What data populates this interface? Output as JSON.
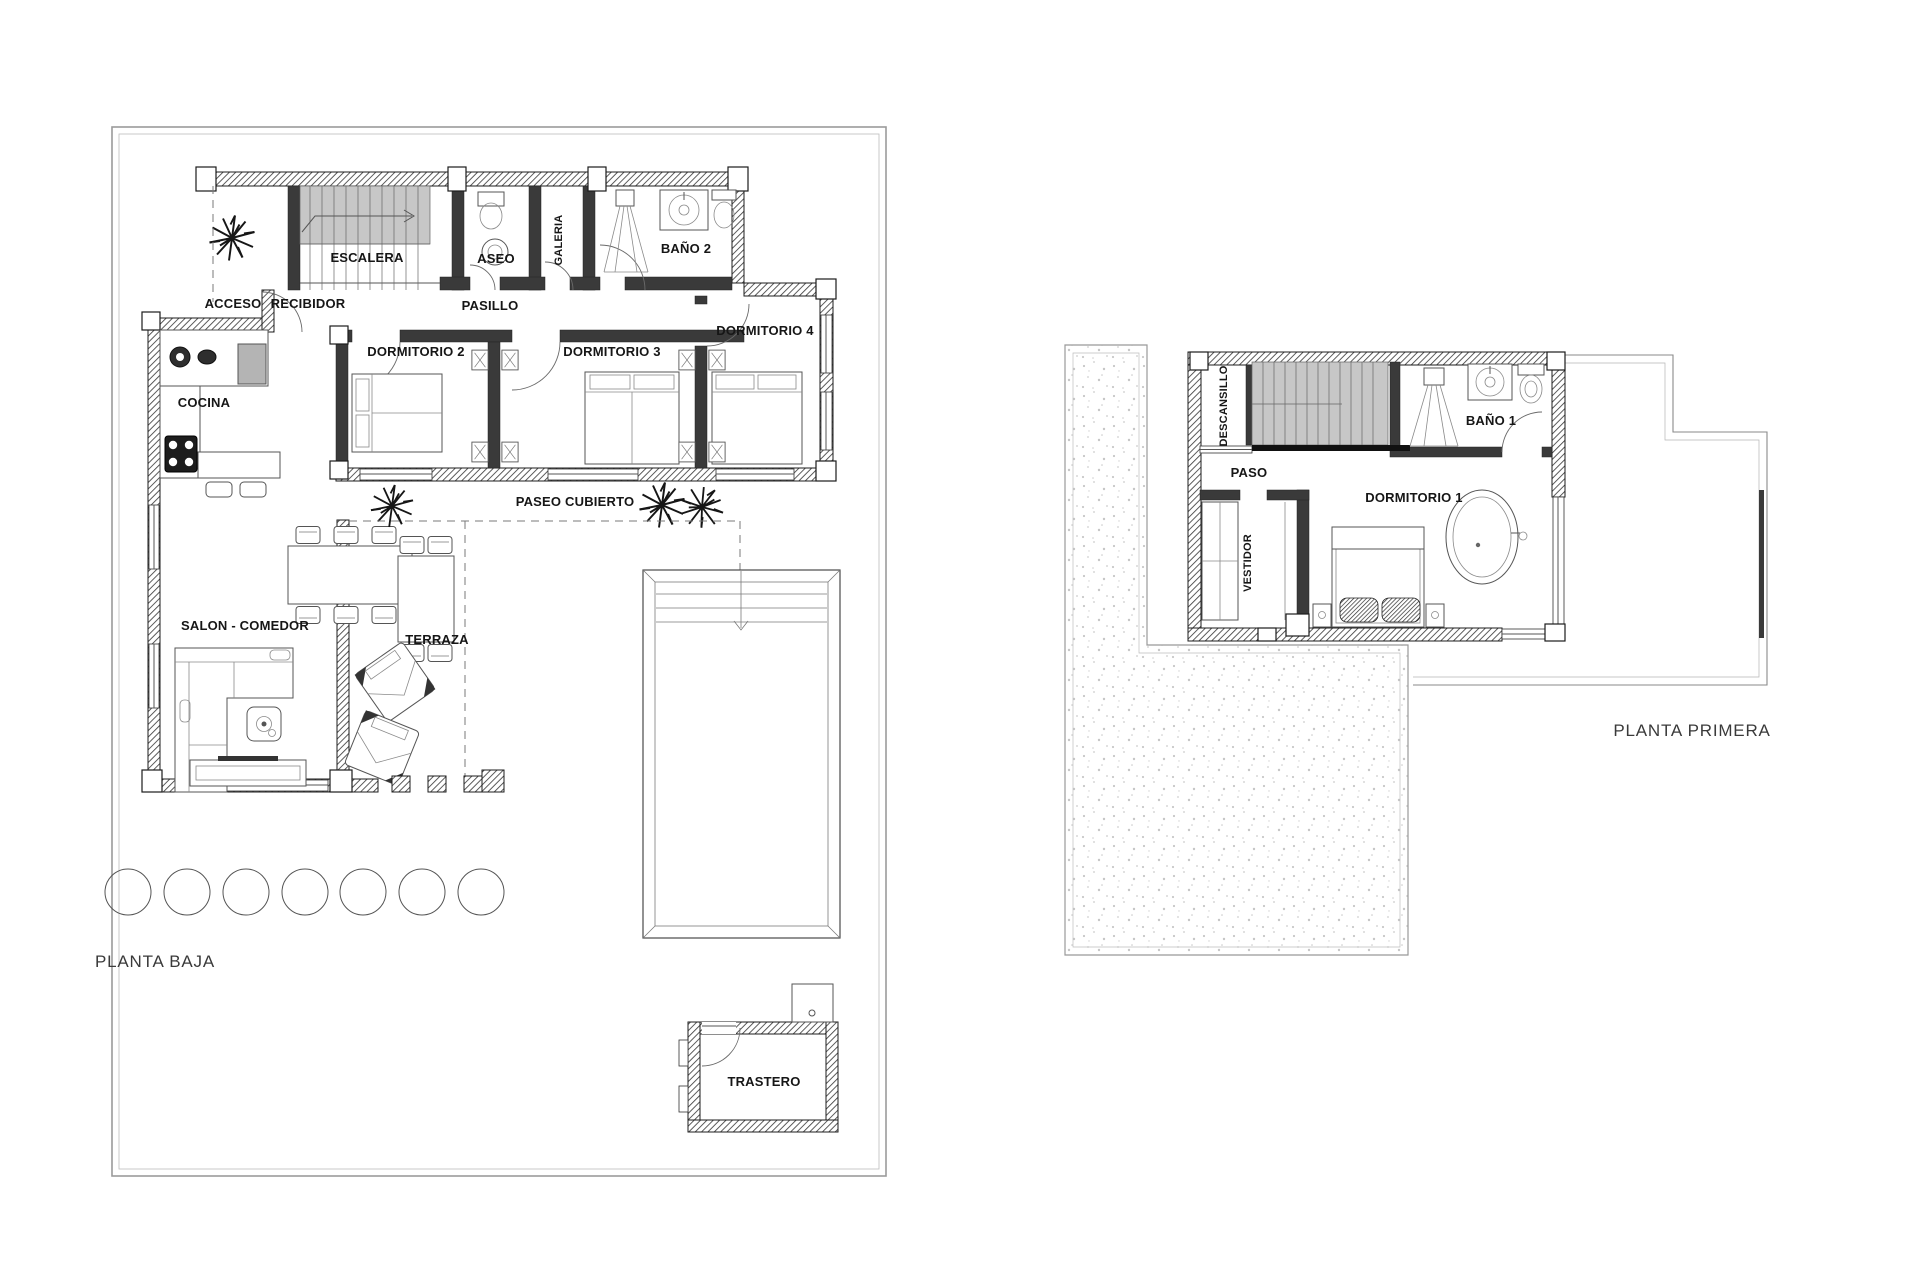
{
  "drawing": {
    "type": "architectural floor plan, two storeys of a villa",
    "background_color": "#ffffff",
    "wall_color": "#1c1c1c",
    "boundary_color": "#9b9b9b",
    "stair_fill_color": "#c7c7c7",
    "label_color": "#161616",
    "title_color": "#3a3a3a"
  },
  "ground_floor": {
    "title": "PLANTA BAJA",
    "rooms": {
      "escalera": "ESCALERA",
      "aseo": "ASEO",
      "galeria": "GALERIA",
      "bano2": "BAÑO 2",
      "acceso": "ACCESO",
      "recibidor": "RECIBIDOR",
      "pasillo": "PASILLO",
      "dormitorio2": "DORMITORIO 2",
      "dormitorio3": "DORMITORIO 3",
      "dormitorio4": "DORMITORIO 4",
      "cocina": "COCINA",
      "paseo_cubierto": "PASEO CUBIERTO",
      "salon_comedor": "SALON - COMEDOR",
      "terraza": "TERRAZA",
      "trastero": "TRASTERO"
    },
    "features": [
      "pool",
      "covered walkway",
      "seven landscape circles",
      "storage shed"
    ]
  },
  "first_floor": {
    "title": "PLANTA PRIMERA",
    "rooms": {
      "descansillo": "DESCANSILLO",
      "paso": "PASO",
      "bano1": "BAÑO 1",
      "dormitorio1": "DORMITORIO 1",
      "vestidor": "VESTIDOR"
    },
    "features": [
      "stippled roof terrace",
      "freestanding bathtub",
      "roof outline"
    ]
  }
}
